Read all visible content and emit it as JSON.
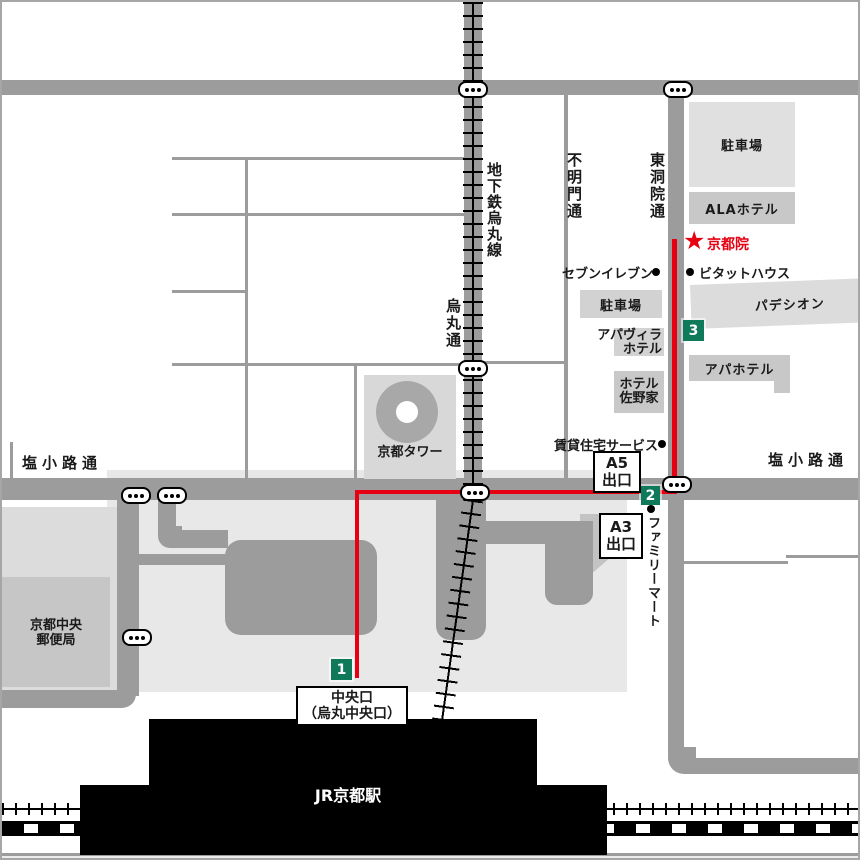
{
  "colors": {
    "route_red": "#e60012",
    "marker_green": "#0f7a5a",
    "road_gray": "#9c9c9c"
  },
  "streets": {
    "shiokoji_left": "塩小路通",
    "shiokoji_right": "塩小路通",
    "karasuma": "烏丸通",
    "subway_karasuma_line": "地下鉄烏丸線",
    "akezumon": "不明門通",
    "higashinotoin": "東洞院通"
  },
  "destination": {
    "star": "★",
    "name": "京都院"
  },
  "route_markers": {
    "m1": "1",
    "m2": "2",
    "m3": "3"
  },
  "buildings": {
    "parking_north": "駐車場",
    "ala_hotel": "ALAホテル",
    "padession": "パデシオン",
    "apa_hotel": "アパホテル",
    "parking_central": "駐車場",
    "apa_villa_line1": "アパヴィラ",
    "apa_villa_line2": "ホテル",
    "sanoya_line1": "ホテル",
    "sanoya_line2": "佐野家",
    "kyoto_tower": "京都タワー",
    "post_office_line1": "京都中央",
    "post_office_line2": "郵便局",
    "jr_kyoto_station": "JR京都駅"
  },
  "pois": {
    "seven_eleven": "セブンイレブン",
    "bitat_house": "ビタットハウス",
    "rental_service": "賃貸住宅サービス",
    "family_mart": "ファミリーマート"
  },
  "exits": {
    "a5_line1": "A5",
    "a5_line2": "出口",
    "a3_line1": "A3",
    "a3_line2": "出口"
  },
  "gate": {
    "line1": "中央口",
    "line2": "（烏丸中央口）"
  }
}
